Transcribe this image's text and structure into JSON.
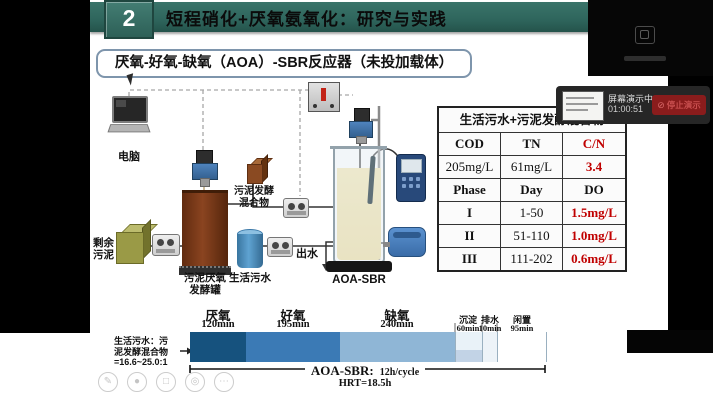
{
  "header": {
    "number": "2",
    "title": "短程硝化+厌氧氨氧化：研究与实践"
  },
  "subtitle": "厌氧-好氧-缺氧（AOA）-SBR反应器（未投加载体）",
  "diagram": {
    "computer_label": "电脑",
    "excess_sludge_label": "剩余污泥",
    "fermenter_label": "污泥厌氧发酵罐",
    "mixture_label": "污泥发酵混合物",
    "sewage_label": "生活污水",
    "effluent_label": "出水",
    "reactor_label": "AOA-SBR"
  },
  "table": {
    "title": "生活污水+污泥发酵混合物",
    "cells": [
      [
        "COD",
        "TN",
        "C/N"
      ],
      [
        "205mg/L",
        "61mg/L",
        "3.4"
      ],
      [
        "Phase",
        "Day",
        "DO"
      ],
      [
        "I",
        "1-50",
        "1.5mg/L"
      ],
      [
        "II",
        "51-110",
        "1.0mg/L"
      ],
      [
        "III",
        "111-202",
        "0.6mg/L"
      ]
    ]
  },
  "timeline": {
    "ratio_lines": [
      "生活污水：污",
      "泥发酵混合物",
      "=16.6~25.0:1"
    ],
    "phases": [
      {
        "name": "厌氧",
        "duration": "120min"
      },
      {
        "name": "好氧",
        "duration": "195min"
      },
      {
        "name": "缺氧",
        "duration": "240min"
      },
      {
        "name": "沉淀",
        "duration": "60min"
      },
      {
        "name": "排水",
        "duration": "10min"
      },
      {
        "name": "闲置",
        "duration": "95min"
      }
    ],
    "cycle_label": "AOA-SBR:",
    "cycle_value": "12h/cycle",
    "hrt": "HRT=18.5h"
  },
  "share_overlay": {
    "status": "屏幕演示中",
    "elapsed": "01:00:51",
    "stop_label": "停止演示"
  },
  "icons": {
    "stop": "⊘",
    "pen": "✎",
    "laser": "●",
    "frame": "□",
    "zoom": "◎",
    "more": "⋯"
  },
  "colors": {
    "header_teal": "#2e655c",
    "alert_red": "#c00000",
    "anaerobic_blue": "#16527e",
    "aerobic_blue": "#3b7ab5",
    "anoxic_blue": "#8fb6d6",
    "tank_brown": "#7c3a16"
  }
}
